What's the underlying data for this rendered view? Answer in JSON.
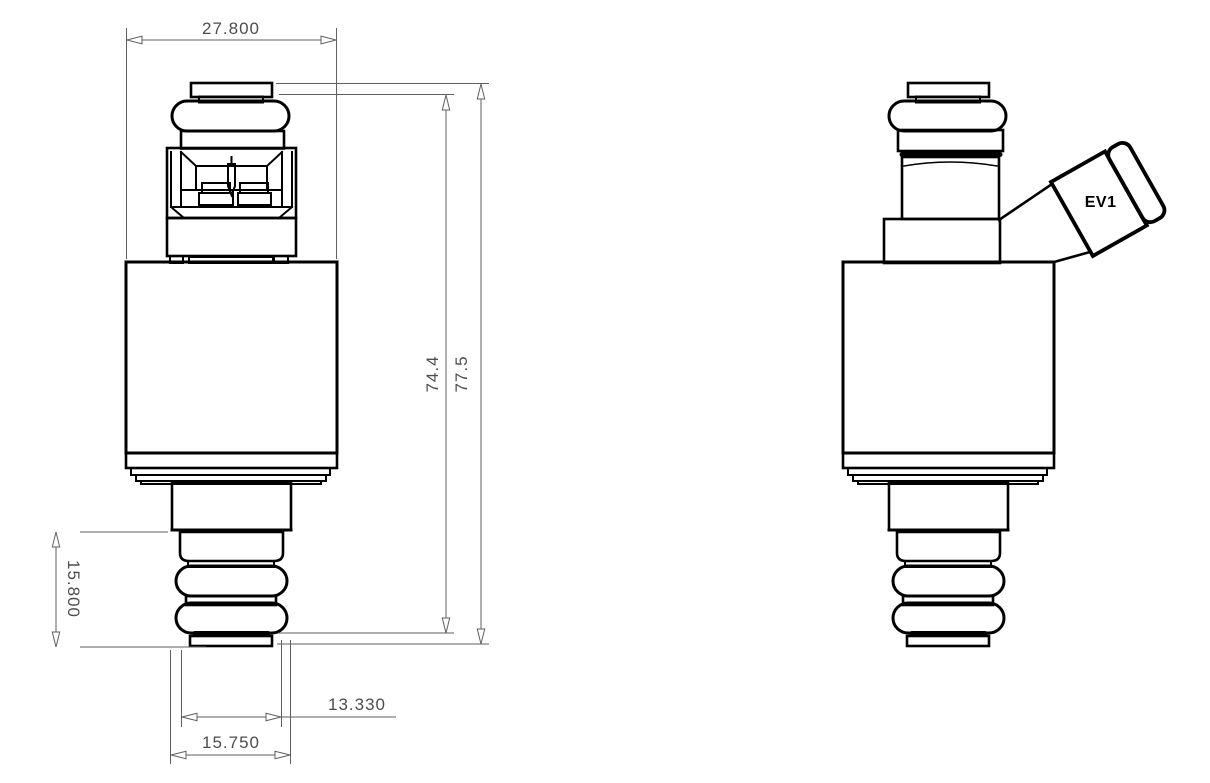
{
  "page": {
    "background": "#ffffff"
  },
  "colors": {
    "part_outline": "#000000",
    "dimension_line": "#5f5f5f",
    "dimension_text": "#4d4d4d",
    "connector_label": "#000000"
  },
  "front_view": {
    "dimensions": {
      "top_width": "27.800",
      "height_to_seat": "74.4",
      "overall_height": "77.5",
      "lower_stack_height": "15.800",
      "tip_seat_width": "13.330",
      "lower_body_width": "15.750"
    }
  },
  "side_view": {
    "connector_label": "EV1"
  }
}
